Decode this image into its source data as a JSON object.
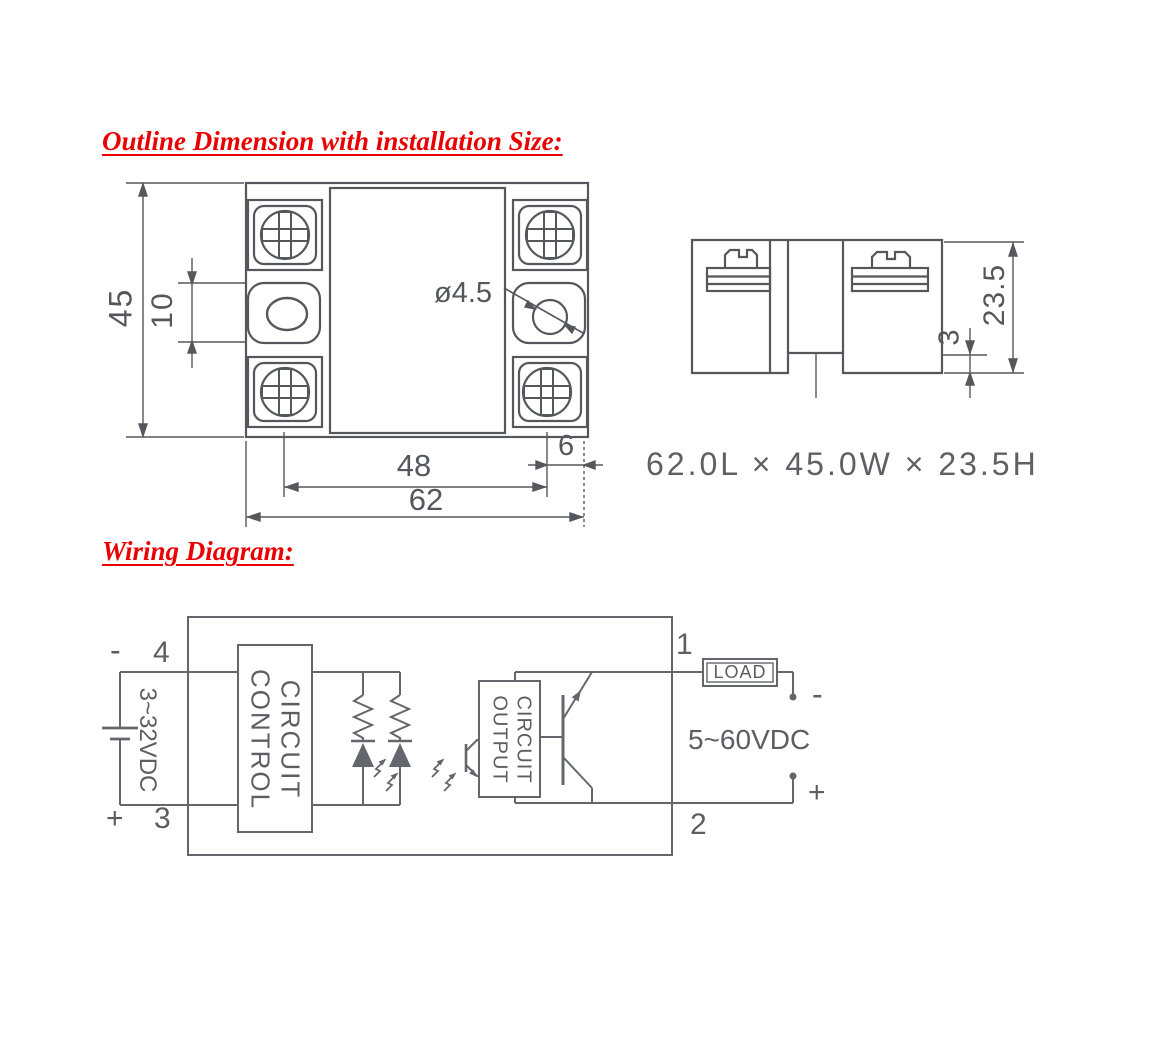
{
  "sections": {
    "outline_title": "Outline Dimension with installation Size:",
    "wiring_title": "Wiring Diagram:"
  },
  "outline_drawing": {
    "front_view": {
      "height_mm": "45",
      "slot_pitch_mm": "10",
      "hole_dia": "ø4.5",
      "screw_span_mm": "48",
      "width_mm": "62",
      "edge_offset_mm": "6"
    },
    "side_view": {
      "height_mm": "23.5",
      "notch_mm": "3"
    },
    "overall_size": "62.0L × 45.0W × 23.5H"
  },
  "wiring": {
    "terminal_4": "4",
    "terminal_3": "3",
    "terminal_1": "1",
    "terminal_2": "2",
    "input_minus": "-",
    "input_plus": "+",
    "output_minus": "-",
    "output_plus": "+",
    "input_voltage": "3~32VDC",
    "output_voltage": "5~60VDC",
    "control_circuit_line1": "CONTROL",
    "control_circuit_line2": "CIRCUIT",
    "output_circuit_line1": "OUTPUT",
    "output_circuit_line2": "CIRCUIT",
    "load": "LOAD"
  }
}
